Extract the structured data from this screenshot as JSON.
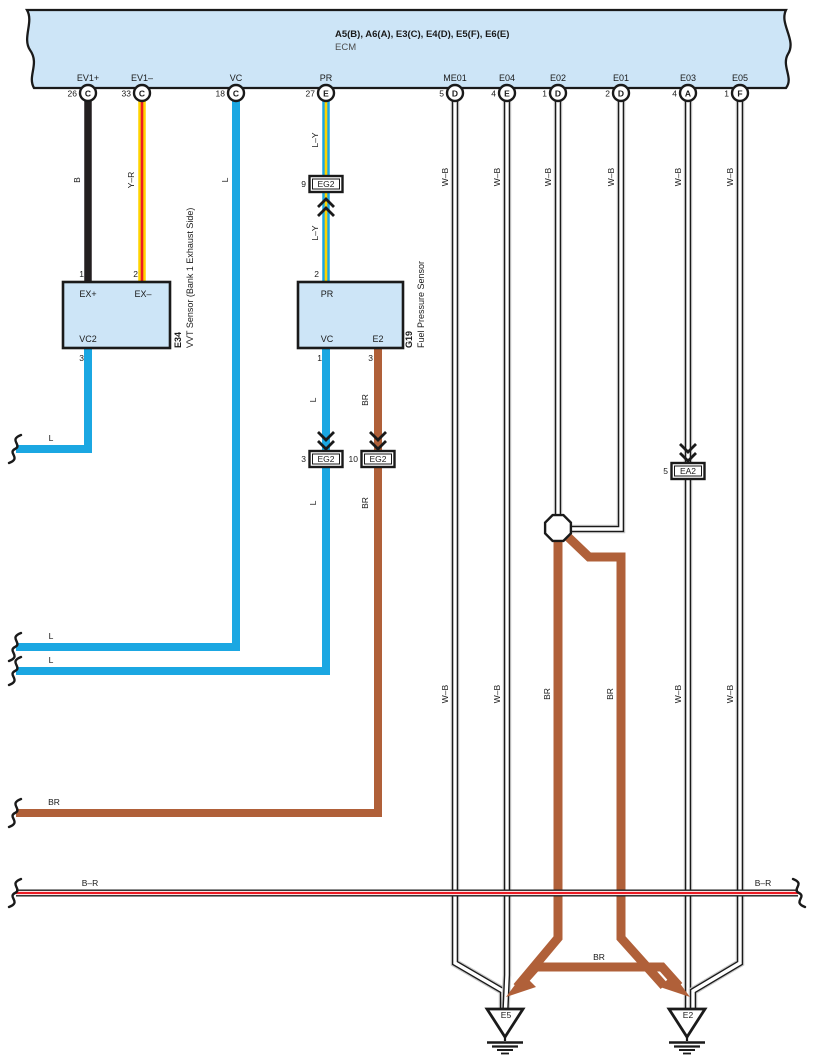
{
  "colors": {
    "blue": "#1ba7e2",
    "yellow": "#ffd400",
    "red": "#ec1c24",
    "brown": "#b06039",
    "black_wire": "#231f20",
    "wb_gray": "#c9c9c9",
    "block_fill": "#cde5f7"
  },
  "ecm": {
    "title": "A5(B), A6(A), E3(C), E4(D), E5(F), E6(E)",
    "name": "ECM"
  },
  "pins": [
    {
      "label": "EV1+",
      "num": "26",
      "conn": "C"
    },
    {
      "label": "EV1–",
      "num": "33",
      "conn": "C"
    },
    {
      "label": "VC",
      "num": "18",
      "conn": "C"
    },
    {
      "label": "PR",
      "num": "27",
      "conn": "E"
    },
    {
      "label": "ME01",
      "num": "5",
      "conn": "D"
    },
    {
      "label": "E04",
      "num": "4",
      "conn": "E"
    },
    {
      "label": "E02",
      "num": "1",
      "conn": "D"
    },
    {
      "label": "E01",
      "num": "2",
      "conn": "D"
    },
    {
      "label": "E03",
      "num": "4",
      "conn": "A"
    },
    {
      "label": "E05",
      "num": "1",
      "conn": "F"
    }
  ],
  "wire_labels": {
    "b": "B",
    "y_r": "Y–R",
    "l": "L",
    "l_y": "L–Y",
    "w_b": "W–B",
    "br": "BR",
    "b_r": "B–R"
  },
  "vvt_sensor": {
    "code": "E34",
    "name": "VVT Sensor (Bank 1 Exhaust Side)",
    "pin_ex_plus": "EX+",
    "pin_ex_minus": "EX–",
    "pin_vc2": "VC2",
    "num_ex_plus": "1",
    "num_ex_minus": "2",
    "num_vc2": "3"
  },
  "fuel_pressure_sensor": {
    "code": "G19",
    "name": "Fuel Pressure Sensor",
    "pin_pr": "PR",
    "pin_vc": "VC",
    "pin_e2": "E2",
    "num_pr": "2",
    "num_vc": "1",
    "num_e2": "3"
  },
  "connectors": {
    "eg2": "EG2",
    "ea2": "EA2",
    "num_pr": "9",
    "num_vc": "3",
    "num_e2": "10",
    "num_ea2": "5"
  },
  "grounds": {
    "left": "E5",
    "right": "E2"
  }
}
